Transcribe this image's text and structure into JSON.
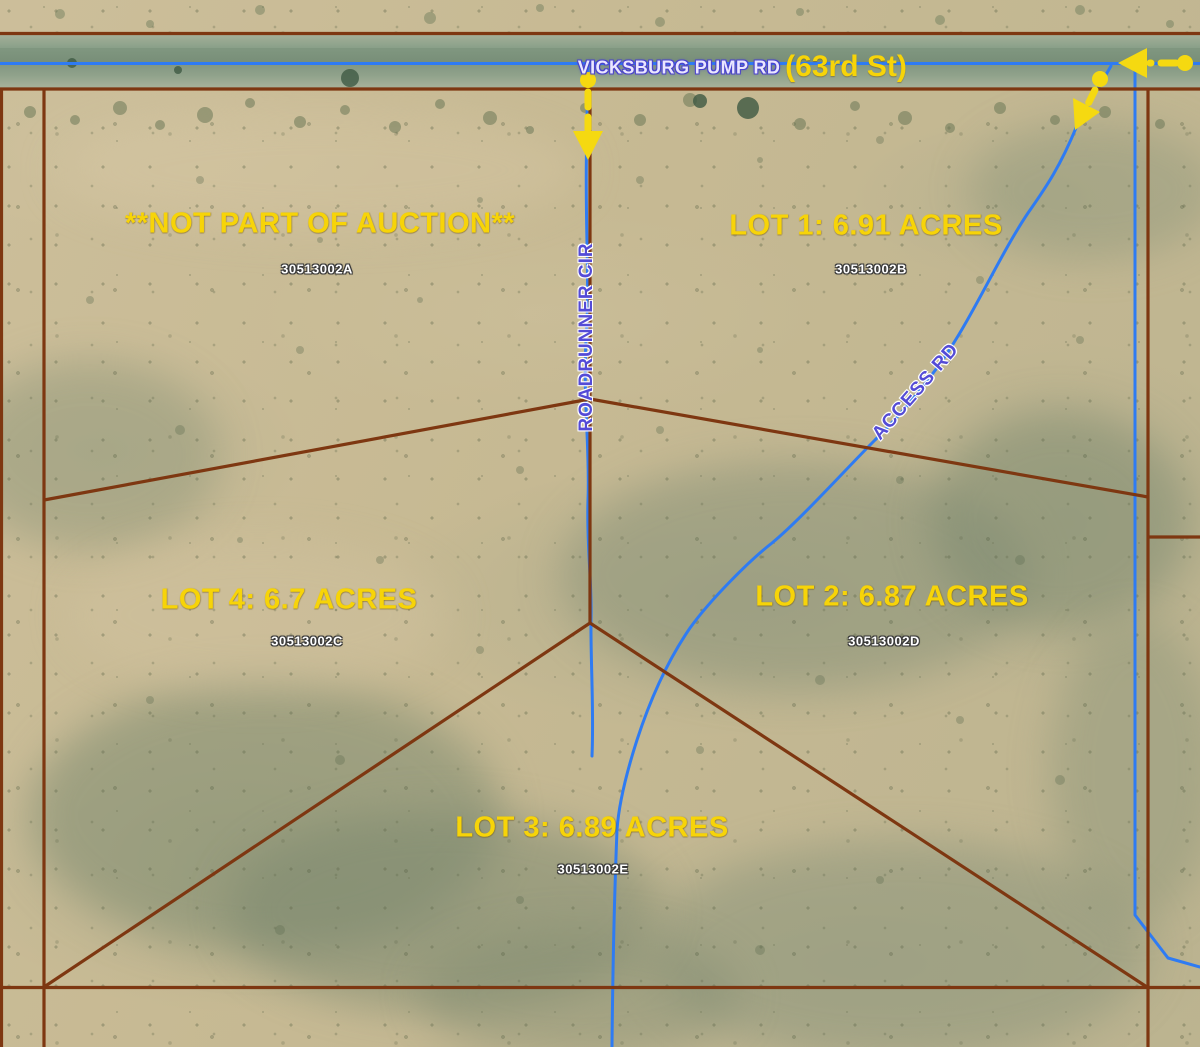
{
  "colors": {
    "boundary_brown": "#7e3711",
    "road_blue": "#2e7bf3",
    "label_yellow": "#f7d408",
    "road_label_light": "#eae6ff",
    "road_label_outline": "#4a43cc",
    "road_label_purple": "#544bd6",
    "apn_white": "#ffffff",
    "arrow_yellow": "#f5d911"
  },
  "roads": {
    "vicksburg": "VICKSBURG PUMP RD",
    "street": "(63rd St)",
    "roadrunner": "ROADRUNNER CIR",
    "access": "ACCESS RD"
  },
  "parcels": {
    "excluded": {
      "label": "**NOT PART OF AUCTION**",
      "apn": "30513002A"
    },
    "lot1": {
      "label": "LOT 1: 6.91 ACRES",
      "apn": "30513002B"
    },
    "lot2": {
      "label": "LOT 2: 6.87 ACRES",
      "apn": "30513002D"
    },
    "lot3": {
      "label": "LOT 3: 6.89 ACRES",
      "apn": "30513002E"
    },
    "lot4": {
      "label": "LOT 4: 6.7 ACRES",
      "apn": "30513002C"
    }
  }
}
